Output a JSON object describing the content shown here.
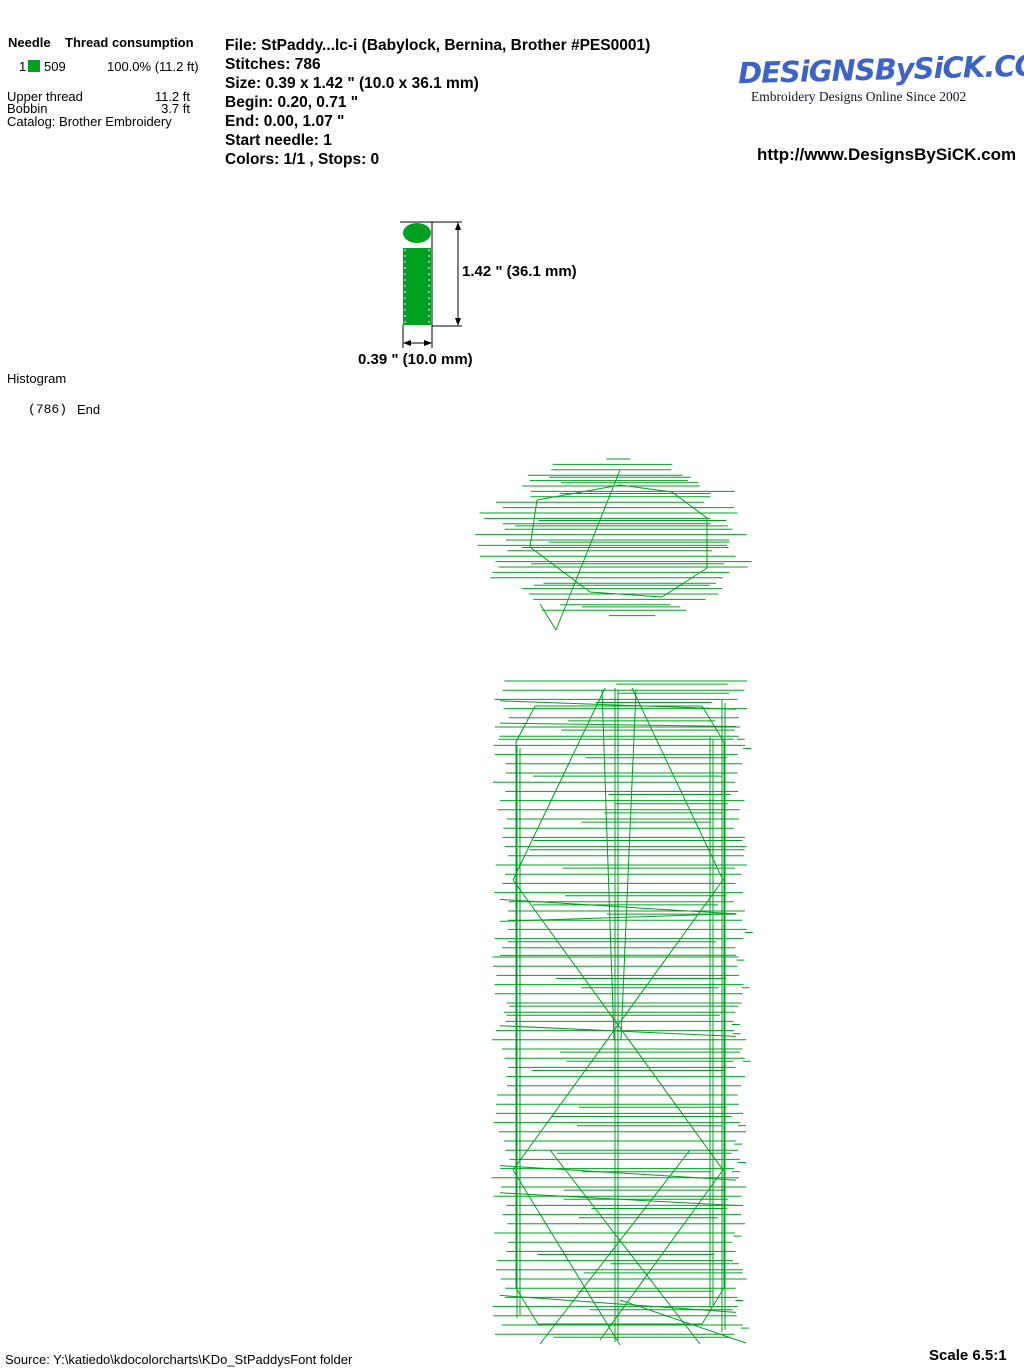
{
  "needle_table": {
    "header": {
      "needle": "Needle",
      "consumption": "Thread consumption"
    },
    "row": {
      "needle_number": "1",
      "swatch_color": "#00A020",
      "color_code": "509",
      "usage": "100.0% (11.2 ft)"
    },
    "details": [
      {
        "label": "Upper thread",
        "value": "11.2 ft"
      },
      {
        "label": "Bobbin",
        "value": "3.7 ft"
      }
    ],
    "catalog": "Catalog: Brother Embroidery"
  },
  "file_info": {
    "lines": [
      "File: StPaddy...lc-i  (Babylock, Bernina, Brother #PES0001)",
      "Stitches: 786",
      "Size: 0.39 x 1.42 \" (10.0 x 36.1 mm)",
      "Begin: 0.20, 0.71 \"",
      "End: 0.00, 1.07 \"",
      "Start needle: 1",
      "Colors: 1/1 , Stops: 0"
    ]
  },
  "logo": {
    "brand": "DESiGNSBySiCK.COM",
    "brand_color": "#3C64C8",
    "tagline": "Embroidery Designs Online Since 2002",
    "url": "http://www.DesignsBySiCK.com"
  },
  "preview": {
    "fill_color": "#00A020",
    "height_label": "1.42 \" (36.1 mm)",
    "width_label": "0.39 \" (10.0 mm)"
  },
  "histogram": {
    "title": "Histogram",
    "count": "(786)",
    "end_label": "End"
  },
  "footer": {
    "source": "Source: Y:\\katiedo\\kdocolorcharts\\KDo_StPaddysFont folder",
    "scale": "Scale 6.5:1"
  },
  "figure": {
    "color": "#00A020",
    "seed": 7,
    "dot": {
      "cx": 617,
      "cy": 537,
      "rx": 122,
      "ry": 82,
      "step": 5.4
    },
    "bar": {
      "x1": 496,
      "x2": 740,
      "y1": 677,
      "y2": 1344,
      "step": 9.2
    }
  }
}
